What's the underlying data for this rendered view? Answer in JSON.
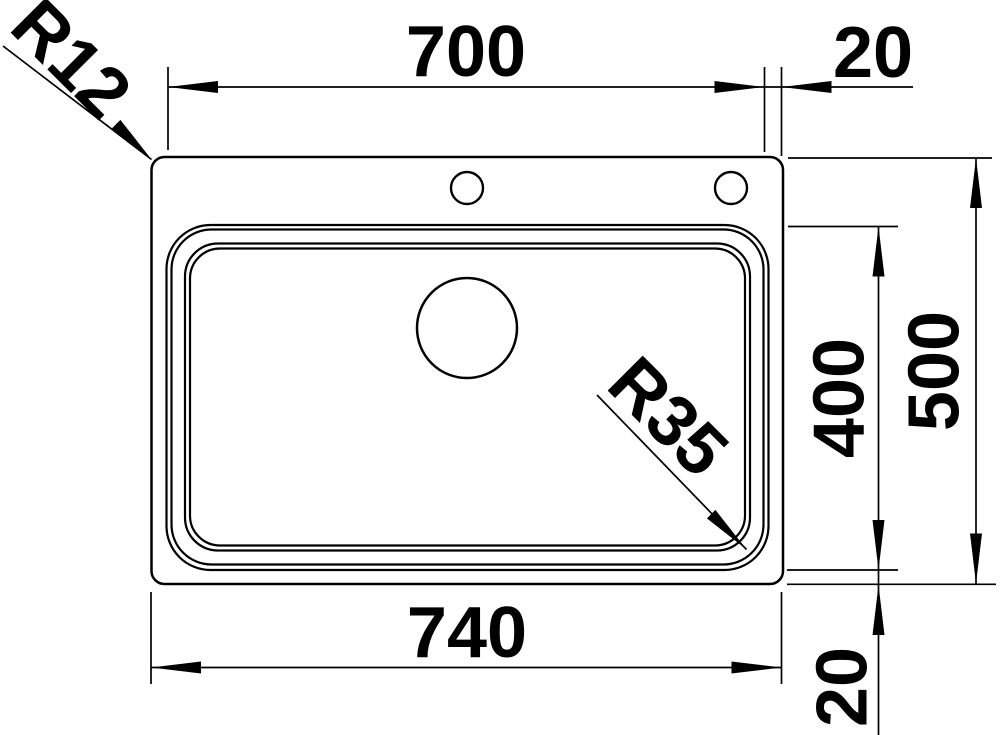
{
  "drawing": {
    "background_color": "#ffffff",
    "line_color": "#000000",
    "dimensions": {
      "bowl_width_top": {
        "label": "700"
      },
      "rim_offset_top_right": {
        "label": "20"
      },
      "bowl_depth_right": {
        "label": "400"
      },
      "overall_depth_right": {
        "label": "500"
      },
      "overall_width_bottom": {
        "label": "740"
      },
      "rim_offset_bottom_right": {
        "label": "20"
      },
      "outer_corner_radius": {
        "label": "R12"
      },
      "bowl_corner_radius": {
        "label": "R35"
      }
    }
  }
}
